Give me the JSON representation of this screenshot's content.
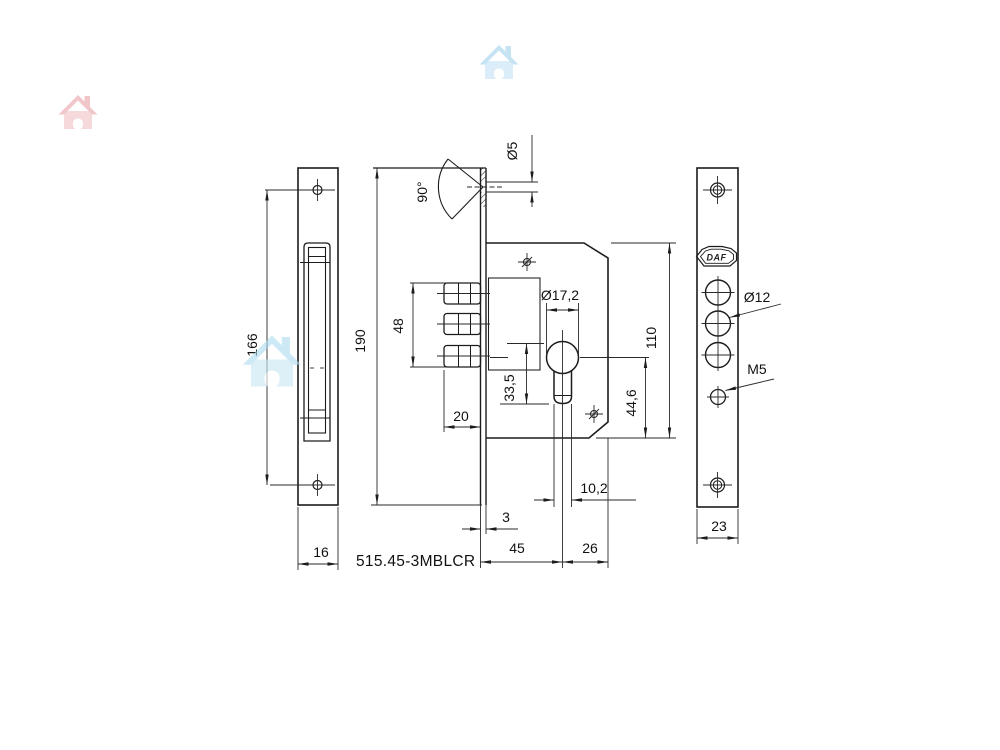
{
  "drawing": {
    "part_number": "515.45-3MBLCR",
    "brand": "DAF",
    "labels": {
      "left_plate_hole_spacing": "166",
      "left_plate_width": "16",
      "faceplate_height": "190",
      "bolt_group_height": "48",
      "bolt_length": "20",
      "countersink_angle": "90°",
      "hole_diameter": "Ø5",
      "cylinder_diameter": "Ø17,2",
      "cylinder_height": "33,5",
      "body_height": "110",
      "cylinder_to_bottom": "44,6",
      "stem_width": "10,2",
      "faceplate_thickness": "3",
      "backset": "45",
      "center_to_edge": "26",
      "right_hole_diameter": "Ø12",
      "screw_thread": "M5",
      "right_plate_width": "23"
    }
  }
}
